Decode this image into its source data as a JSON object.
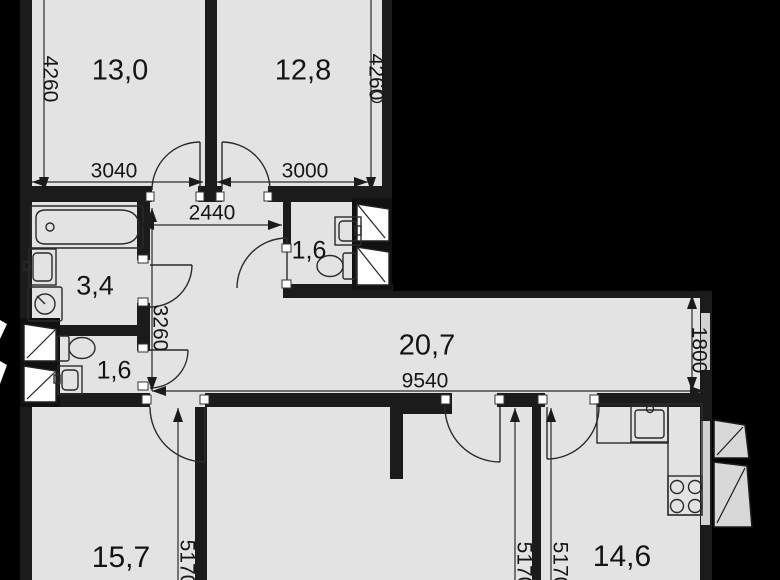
{
  "plan_title": "apartment-floor-plan",
  "rooms": {
    "bedroom1": {
      "area": "13,0"
    },
    "bedroom2": {
      "area": "12,8"
    },
    "wc_top": {
      "area": "1,6"
    },
    "bathroom": {
      "area": "3,4"
    },
    "wc_bottom": {
      "area": "1,6"
    },
    "living": {
      "area": "20,7"
    },
    "bedroom3": {
      "area": "15,7"
    },
    "kitchen": {
      "area": "14,6"
    }
  },
  "dimensions_mm": {
    "bedroom1_depth": "4260",
    "bedroom1_width": "3040",
    "bedroom2_width": "3000",
    "bedroom2_depth": "4260",
    "hall_width": "2440",
    "hall_depth": "3260",
    "living_length": "9540",
    "living_depth": "1800",
    "bedroom3_depth": "5170",
    "middle_room_depth": "5170",
    "kitchen_depth": "5170"
  },
  "fixtures": [
    "bathtub",
    "washbasin",
    "washing-machine",
    "toilet",
    "kitchen-sink",
    "stove",
    "countertop",
    "duct-shaft",
    "balcony-window"
  ],
  "colors": {
    "background": "#000000",
    "floor": "#e3e3e3",
    "walls": "#1b1b1b",
    "lines": "#2b2b2b"
  }
}
